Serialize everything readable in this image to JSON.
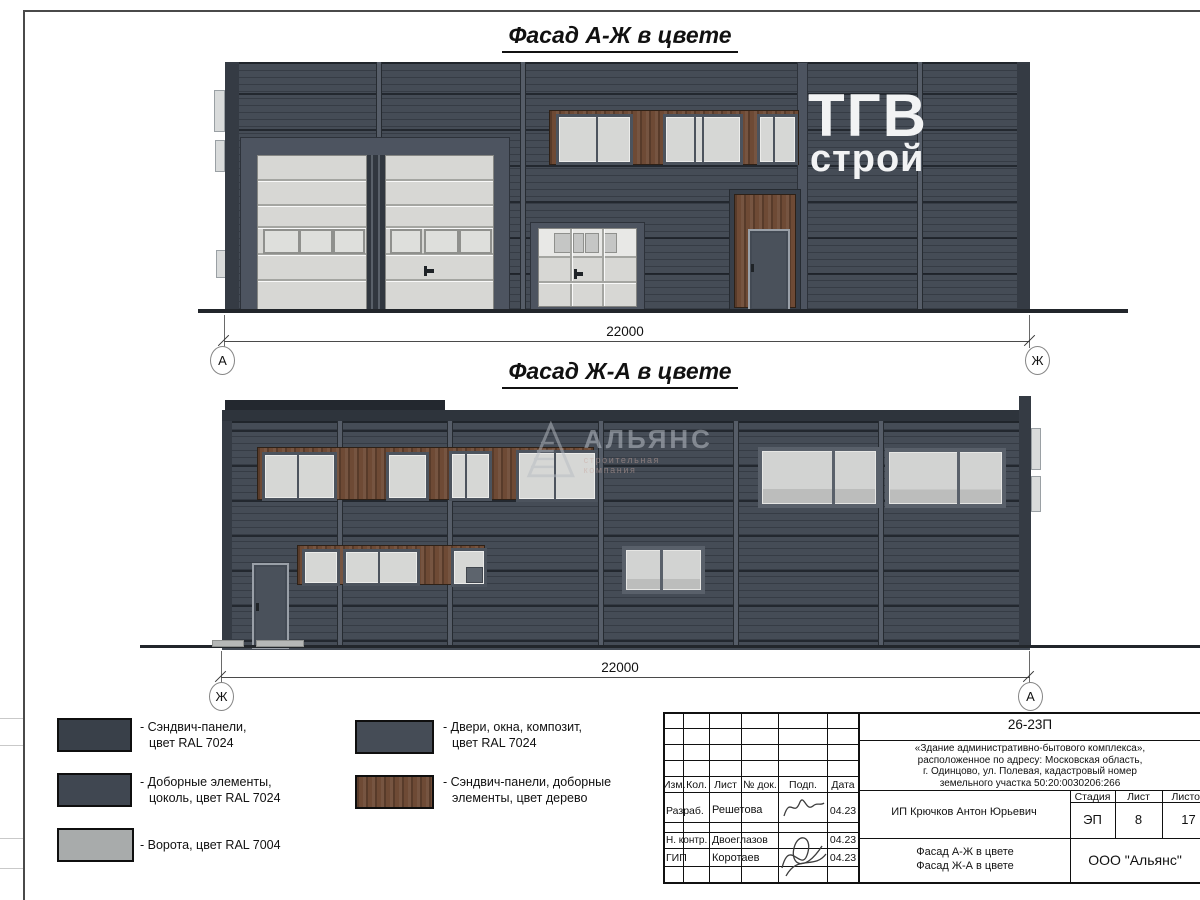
{
  "colors": {
    "ral7024_sandwich_panels": "#394049",
    "ral7024_extra_elements": "#404751",
    "ral7024_doors_windows": "#454c56",
    "ral7004_gates": "#a8abab",
    "wood": "#6e4a35",
    "facade_wall": "#3e454f",
    "sign_text": "#f2f3f4"
  },
  "facade_top": {
    "title": "Фасад А-Ж в цвете",
    "dimension": "22000",
    "axis_left": "А",
    "axis_right": "Ж",
    "sign_line1": "ТГВ",
    "sign_line2": "строй"
  },
  "facade_bottom": {
    "title": "Фасад Ж-А в цвете",
    "dimension": "22000",
    "axis_left": "Ж",
    "axis_right": "А"
  },
  "watermark": {
    "name": "АЛЬЯНС",
    "subtitle": "строительная компания"
  },
  "legend": {
    "items": [
      {
        "line1": "- Сэндвич-панели,",
        "line2": "цвет RAL 7024"
      },
      {
        "line1": "- Доборные элементы,",
        "line2": "цоколь, цвет RAL 7024"
      },
      {
        "line1": "- Ворота, цвет RAL 7004",
        "line2": ""
      },
      {
        "line1": "- Двери, окна, композит,",
        "line2": "цвет RAL 7024"
      },
      {
        "line1": "- Сэндвич-панели, доборные",
        "line2": "элементы, цвет дерево"
      }
    ]
  },
  "stamp": {
    "doc_number": "26-23П",
    "description": {
      "l1": "«Здание административно-бытового комплекса»,",
      "l2": "расположенное по адресу: Московская область,",
      "l3": "г. Одинцово, ул. Полевая, кадастровый номер",
      "l4": "земельного участка 50:20:0030206:266"
    },
    "cols": {
      "c1": "Изм.",
      "c2": "Кол.",
      "c3": "Лист",
      "c4": "№ док.",
      "c5": "Подп.",
      "c6": "Дата"
    },
    "row1": {
      "role": "Разраб.",
      "name": "Решетова",
      "date": "04.23"
    },
    "row2": {
      "role": "Н. контр.",
      "name": "Двоеглазов",
      "date": "04.23"
    },
    "row3": {
      "role": "ГИП",
      "name": "Коротаев",
      "date": "04.23"
    },
    "client": "ИП Крючков Антон Юрьевич",
    "stage_label": "Стадия",
    "stage": "ЭП",
    "sheet_label": "Лист",
    "sheet": "8",
    "sheets_label": "Листов",
    "sheets": "17",
    "title_l1": "Фасад А-Ж в цвете",
    "title_l2": "Фасад Ж-А в цвете",
    "org": "ООО \"Альянс\""
  }
}
